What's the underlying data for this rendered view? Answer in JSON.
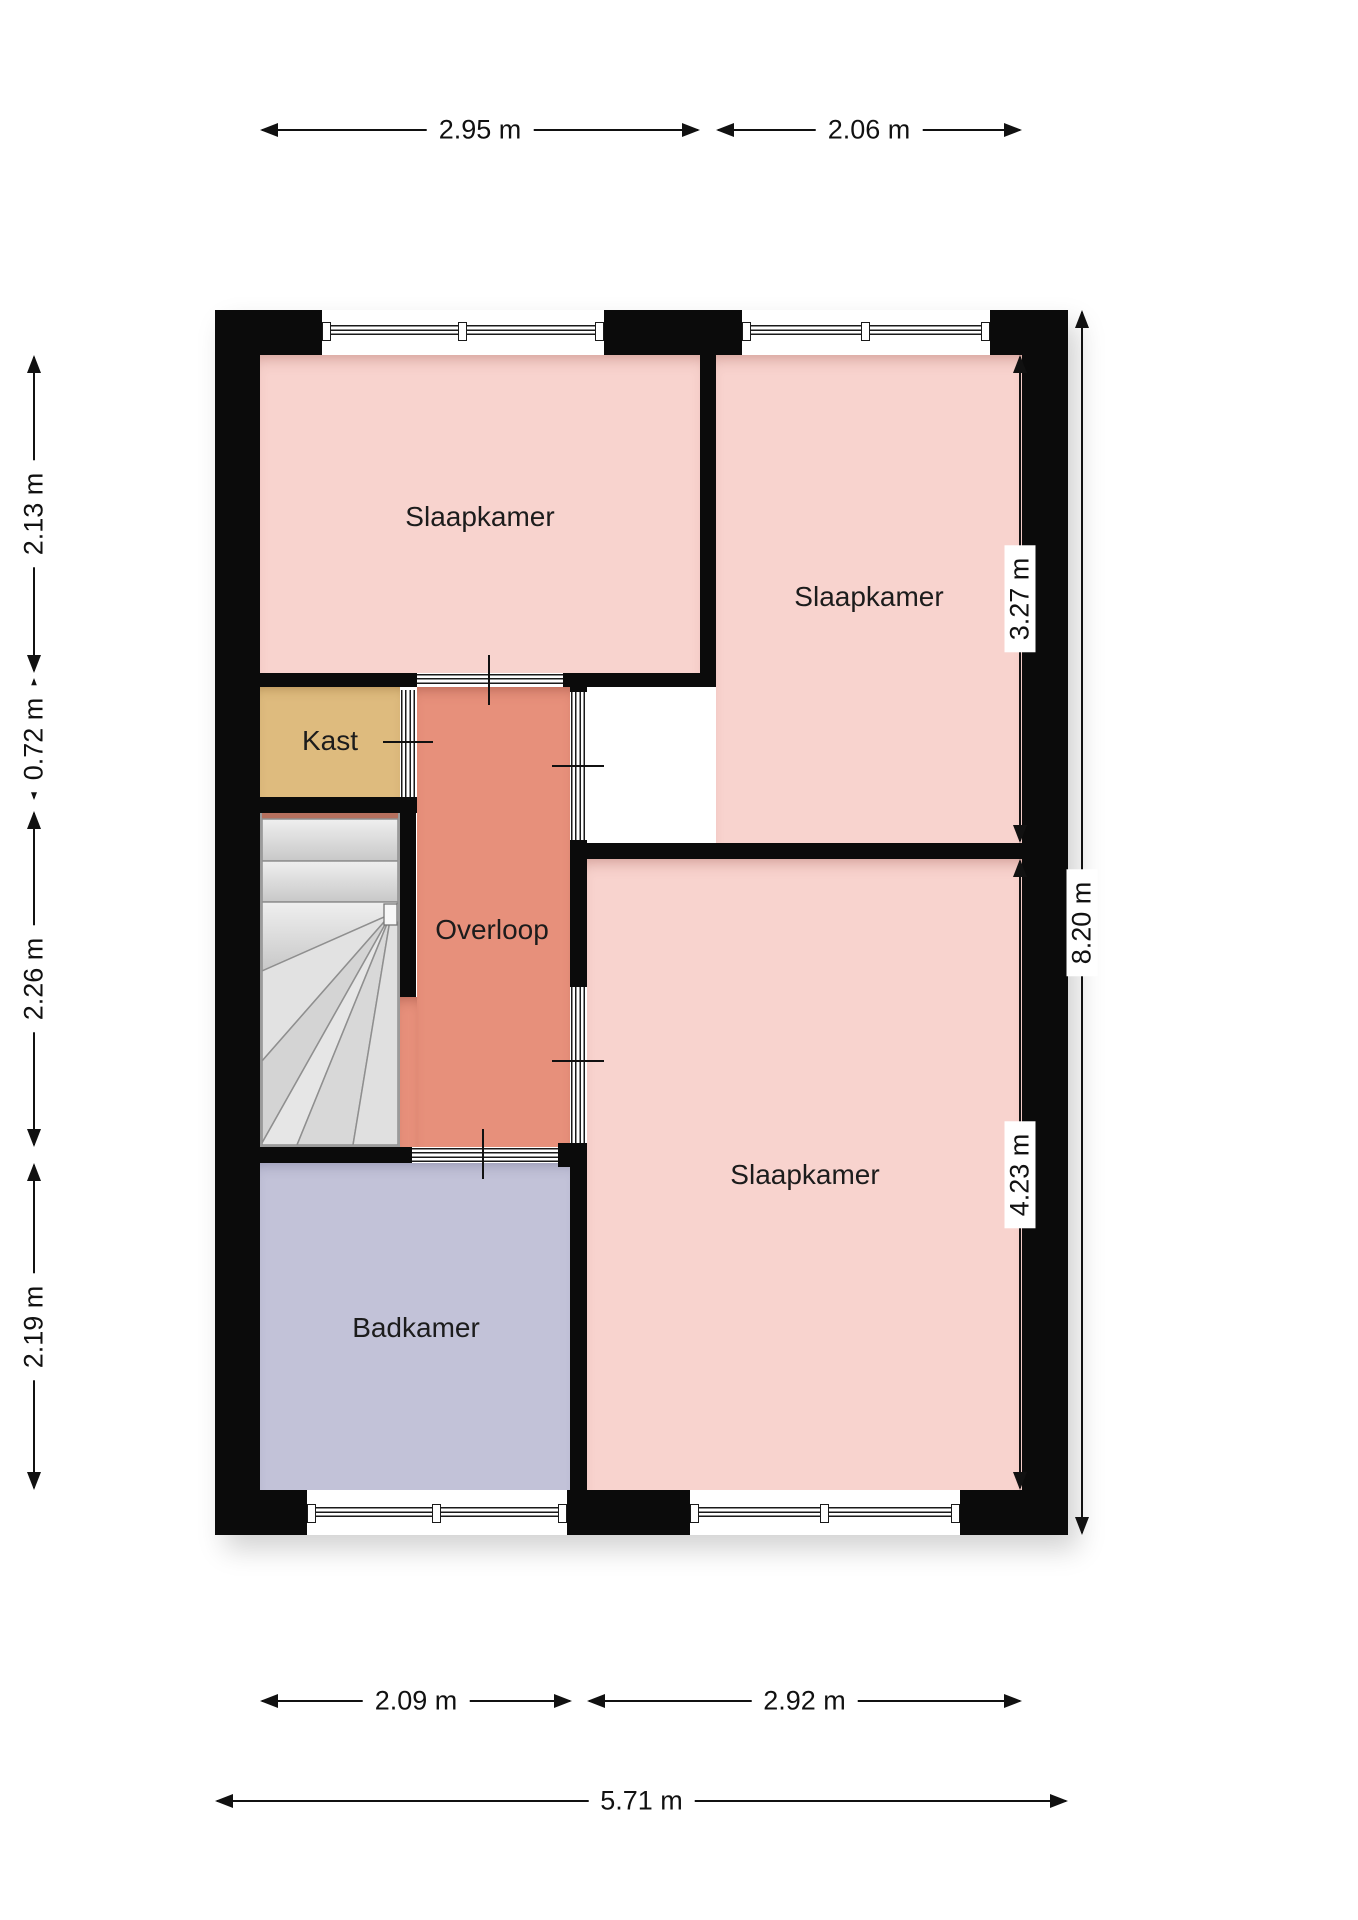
{
  "plan": {
    "title": "floorplan-first-floor",
    "rooms": [
      {
        "name": "slaapkamer-top-left",
        "label": "Slaapkamer"
      },
      {
        "name": "slaapkamer-top-right",
        "label": "Slaapkamer"
      },
      {
        "name": "slaapkamer-bottom-right",
        "label": "Slaapkamer"
      },
      {
        "name": "kast",
        "label": "Kast"
      },
      {
        "name": "overloop",
        "label": "Overloop"
      },
      {
        "name": "badkamer",
        "label": "Badkamer"
      }
    ],
    "dimensions": {
      "top": [
        {
          "value": "2.95 m"
        },
        {
          "value": "2.06 m"
        }
      ],
      "left": [
        {
          "value": "2.13 m"
        },
        {
          "value": "0.72 m"
        },
        {
          "value": "2.26 m"
        },
        {
          "value": "2.19 m"
        }
      ],
      "right": [
        {
          "value": "3.27 m"
        },
        {
          "value": "4.23 m"
        },
        {
          "value": "8.20 m"
        }
      ],
      "bottom": [
        {
          "value": "2.09 m"
        },
        {
          "value": "2.92 m"
        },
        {
          "value": "5.71 m"
        }
      ]
    },
    "colors": {
      "bedroom": "#f8d3ce",
      "hallway": "#e7907b",
      "closet": "#debb7e",
      "bathroom": "#c2c2d8",
      "stairs": "#d6d6d6",
      "stair_accent": "#b5705e",
      "wall": "#0b0b0b",
      "dimension_text": "#111111"
    }
  }
}
